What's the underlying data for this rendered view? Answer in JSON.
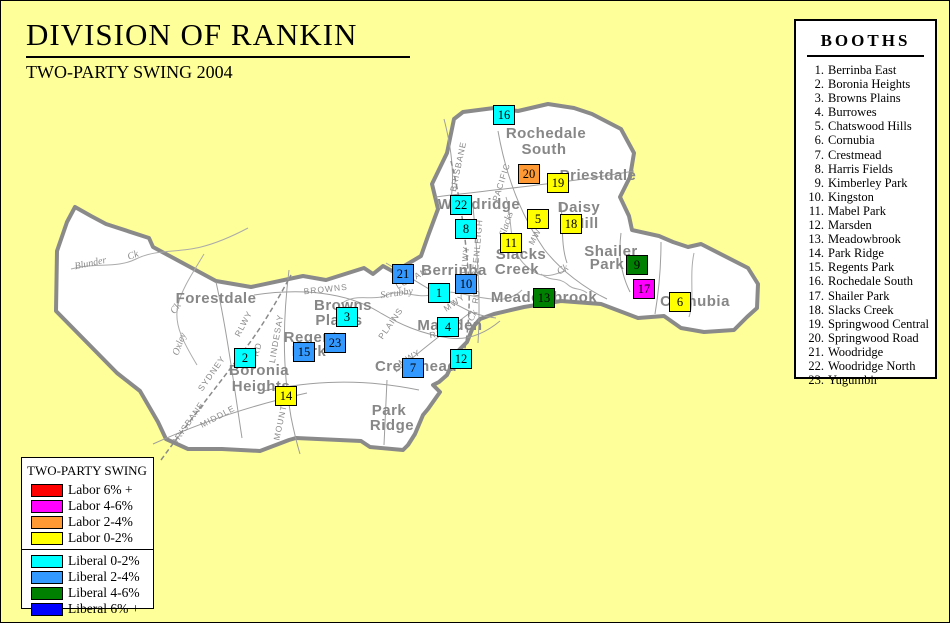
{
  "header": {
    "title": "DIVISION OF RANKIN",
    "subtitle": "TWO-PARTY SWING 2004"
  },
  "booths_panel": {
    "title": "BOOTHS",
    "items": [
      {
        "num": "1.",
        "name": "Berrinba East"
      },
      {
        "num": "2.",
        "name": "Boronia Heights"
      },
      {
        "num": "3.",
        "name": "Browns Plains"
      },
      {
        "num": "4.",
        "name": "Burrowes"
      },
      {
        "num": "5.",
        "name": "Chatswood Hills"
      },
      {
        "num": "6.",
        "name": "Cornubia"
      },
      {
        "num": "7.",
        "name": "Crestmead"
      },
      {
        "num": "8.",
        "name": "Harris Fields"
      },
      {
        "num": "9.",
        "name": "Kimberley Park"
      },
      {
        "num": "10.",
        "name": "Kingston"
      },
      {
        "num": "11.",
        "name": "Mabel Park"
      },
      {
        "num": "12.",
        "name": "Marsden"
      },
      {
        "num": "13.",
        "name": "Meadowbrook"
      },
      {
        "num": "14.",
        "name": "Park Ridge"
      },
      {
        "num": "15.",
        "name": "Regents Park"
      },
      {
        "num": "16.",
        "name": "Rochedale South"
      },
      {
        "num": "17.",
        "name": "Shailer Park"
      },
      {
        "num": "18.",
        "name": "Slacks Creek"
      },
      {
        "num": "19.",
        "name": "Springwood Central"
      },
      {
        "num": "20.",
        "name": "Springwood Road"
      },
      {
        "num": "21.",
        "name": "Woodridge"
      },
      {
        "num": "22.",
        "name": "Woodridge North"
      },
      {
        "num": "23.",
        "name": "Yugumbir"
      }
    ]
  },
  "legend": {
    "title": "TWO-PARTY SWING",
    "labor_rows": [
      {
        "label": "Labor 6% +",
        "color": "#FF0000"
      },
      {
        "label": "Labor 4-6%",
        "color": "#FF00FF"
      },
      {
        "label": "Labor 2-4%",
        "color": "#FF9933"
      },
      {
        "label": "Labor 0-2%",
        "color": "#FFFF00"
      }
    ],
    "liberal_rows": [
      {
        "label": "Liberal 0-2%",
        "color": "#00FFFF"
      },
      {
        "label": "Liberal 2-4%",
        "color": "#3399FF"
      },
      {
        "label": "Liberal 4-6%",
        "color": "#008000"
      },
      {
        "label": "Liberal 6% +",
        "color": "#0000FF"
      }
    ]
  },
  "map": {
    "swing_colors": {
      "lab6": "#FF0000",
      "lab46": "#FF00FF",
      "lab24": "#FF9933",
      "lab02": "#FFFF00",
      "lib02": "#00FFFF",
      "lib24": "#3399FF",
      "lib46": "#008000",
      "lib6": "#0000FF"
    },
    "markers": [
      {
        "n": "1",
        "x": 438,
        "y": 292,
        "cat": "lib02"
      },
      {
        "n": "2",
        "x": 244,
        "y": 357,
        "cat": "lib02"
      },
      {
        "n": "3",
        "x": 346,
        "y": 316,
        "cat": "lib02"
      },
      {
        "n": "4",
        "x": 447,
        "y": 326,
        "cat": "lib02"
      },
      {
        "n": "5",
        "x": 537,
        "y": 218,
        "cat": "lab02"
      },
      {
        "n": "6",
        "x": 679,
        "y": 301,
        "cat": "lab02"
      },
      {
        "n": "7",
        "x": 412,
        "y": 367,
        "cat": "lib24"
      },
      {
        "n": "8",
        "x": 465,
        "y": 228,
        "cat": "lib02"
      },
      {
        "n": "9",
        "x": 636,
        "y": 264,
        "cat": "lib46"
      },
      {
        "n": "10",
        "x": 465,
        "y": 283,
        "cat": "lib24"
      },
      {
        "n": "11",
        "x": 510,
        "y": 242,
        "cat": "lab02"
      },
      {
        "n": "12",
        "x": 460,
        "y": 358,
        "cat": "lib02"
      },
      {
        "n": "13",
        "x": 543,
        "y": 297,
        "cat": "lib46"
      },
      {
        "n": "14",
        "x": 285,
        "y": 395,
        "cat": "lab02"
      },
      {
        "n": "15",
        "x": 303,
        "y": 351,
        "cat": "lib24"
      },
      {
        "n": "16",
        "x": 503,
        "y": 114,
        "cat": "lib02"
      },
      {
        "n": "17",
        "x": 643,
        "y": 288,
        "cat": "lab46"
      },
      {
        "n": "18",
        "x": 570,
        "y": 223,
        "cat": "lab02"
      },
      {
        "n": "19",
        "x": 557,
        "y": 182,
        "cat": "lab02"
      },
      {
        "n": "20",
        "x": 528,
        "y": 173,
        "cat": "lab24"
      },
      {
        "n": "21",
        "x": 402,
        "y": 273,
        "cat": "lib24"
      },
      {
        "n": "22",
        "x": 460,
        "y": 204,
        "cat": "lib02"
      },
      {
        "n": "23",
        "x": 334,
        "y": 342,
        "cat": "lib24"
      }
    ],
    "places": [
      {
        "text": "Forestdale",
        "x": 215,
        "y": 302
      },
      {
        "text": "Rochedale",
        "x": 545,
        "y": 137
      },
      {
        "text": "South",
        "x": 543,
        "y": 153
      },
      {
        "text": "Priestdale",
        "x": 597,
        "y": 179
      },
      {
        "text": "Daisy",
        "x": 578,
        "y": 211
      },
      {
        "text": "Hill",
        "x": 585,
        "y": 227
      },
      {
        "text": "Woodridge",
        "x": 478,
        "y": 208
      },
      {
        "text": "Berrinba",
        "x": 453,
        "y": 274
      },
      {
        "text": "Slacks",
        "x": 520,
        "y": 258
      },
      {
        "text": "Creek",
        "x": 516,
        "y": 273
      },
      {
        "text": "Shailer",
        "x": 610,
        "y": 255
      },
      {
        "text": "Park",
        "x": 606,
        "y": 268
      },
      {
        "text": "Meadowbrook",
        "x": 543,
        "y": 301
      },
      {
        "text": "Cornubia",
        "x": 694,
        "y": 305
      },
      {
        "text": "Marsden",
        "x": 449,
        "y": 329
      },
      {
        "text": "Crestmead",
        "x": 415,
        "y": 370
      },
      {
        "text": "Browns",
        "x": 342,
        "y": 309
      },
      {
        "text": "Plains",
        "x": 338,
        "y": 324
      },
      {
        "text": "Regents",
        "x": 314,
        "y": 341
      },
      {
        "text": "Park",
        "x": 308,
        "y": 355
      },
      {
        "text": "Boronia",
        "x": 258,
        "y": 374
      },
      {
        "text": "Heights",
        "x": 260,
        "y": 390
      },
      {
        "text": "Park",
        "x": 388,
        "y": 414
      },
      {
        "text": "Ridge",
        "x": 391,
        "y": 429
      }
    ],
    "roads": [
      {
        "text": "BROWNS",
        "x": 325,
        "y": 291,
        "r": -6
      },
      {
        "text": "PLAINS",
        "x": 392,
        "y": 324,
        "r": -55
      },
      {
        "text": "RD",
        "x": 436,
        "y": 336,
        "r": -10
      },
      {
        "text": "LOGAN",
        "x": 412,
        "y": 280,
        "r": -28
      },
      {
        "text": "MWY",
        "x": 455,
        "y": 304,
        "r": -35
      },
      {
        "text": "MWY",
        "x": 410,
        "y": 359,
        "r": -30
      },
      {
        "text": "MWY",
        "x": 538,
        "y": 234,
        "r": -62
      },
      {
        "text": "PACIFIC",
        "x": 503,
        "y": 182,
        "r": -72
      },
      {
        "text": "BRISBANE",
        "x": 460,
        "y": 166,
        "r": -78
      },
      {
        "text": "BEENLEIGH",
        "x": 479,
        "y": 247,
        "r": -85
      },
      {
        "text": "RLWY",
        "x": 467,
        "y": 259,
        "r": -85
      },
      {
        "text": "RD",
        "x": 478,
        "y": 296,
        "r": -80
      },
      {
        "text": "SYDNEY",
        "x": 213,
        "y": 374,
        "r": -55
      },
      {
        "text": "BRISBANE",
        "x": 189,
        "y": 424,
        "r": -55
      },
      {
        "text": "RLWY",
        "x": 245,
        "y": 324,
        "r": -62
      },
      {
        "text": "RD",
        "x": 259,
        "y": 349,
        "r": -75
      },
      {
        "text": "LINDESAY",
        "x": 278,
        "y": 338,
        "r": -80
      },
      {
        "text": "MIDDLE",
        "x": 218,
        "y": 418,
        "r": -28
      },
      {
        "text": "MOUNT",
        "x": 282,
        "y": 422,
        "r": -78
      }
    ],
    "creeks": [
      {
        "text": "Blunder",
        "x": 90,
        "y": 265,
        "r": -12
      },
      {
        "text": "Ck",
        "x": 133,
        "y": 257,
        "r": -20
      },
      {
        "text": "Oxley",
        "x": 181,
        "y": 344,
        "r": -70
      },
      {
        "text": "Ck",
        "x": 177,
        "y": 309,
        "r": -55
      },
      {
        "text": "Scrubby",
        "x": 396,
        "y": 295,
        "r": -8
      },
      {
        "text": "Slacks",
        "x": 508,
        "y": 224,
        "r": -72
      },
      {
        "text": "Ck",
        "x": 563,
        "y": 271,
        "r": -30
      },
      {
        "text": "Ck",
        "x": 474,
        "y": 316,
        "r": -60
      }
    ]
  }
}
